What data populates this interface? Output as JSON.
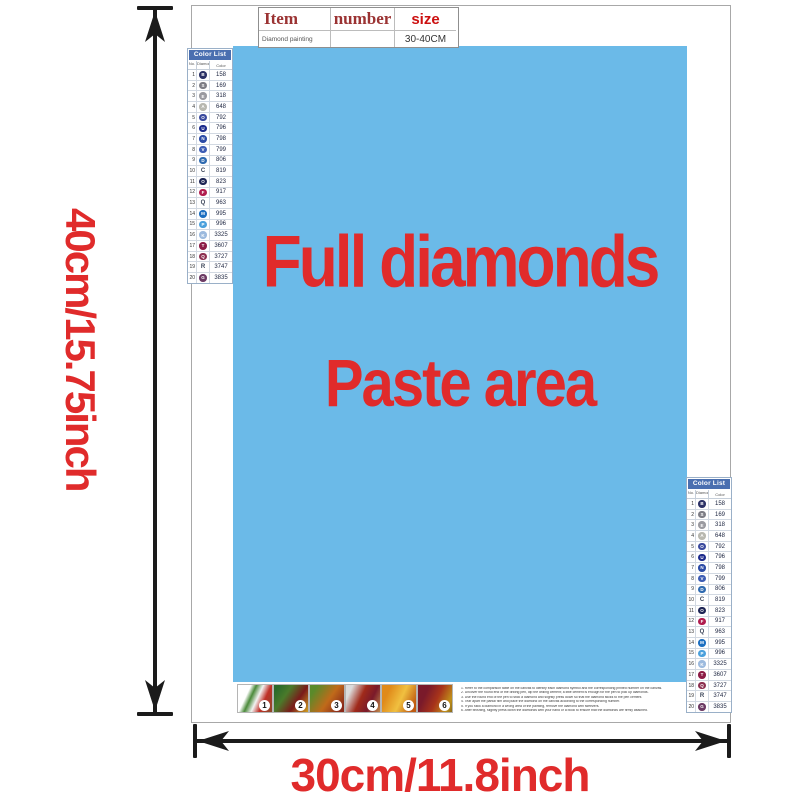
{
  "dimensions": {
    "height_label": "40cm/15.75inch",
    "width_label": "30cm/11.8inch",
    "accent_red": "#e02b2b"
  },
  "item_table": {
    "headers": [
      "Item",
      "number",
      "size"
    ],
    "row": {
      "item": "Diamond painting",
      "number": "",
      "size": "30-40CM"
    }
  },
  "paste_area": {
    "line1": "Full diamonds",
    "line2": "Paste area",
    "bg": "#6bbae8",
    "text_color": "#e02b2b"
  },
  "color_list": {
    "title": "Color List",
    "columns": [
      "No.",
      "Diamond",
      "Color"
    ],
    "header_bg": "#4a6fb0",
    "rows": [
      {
        "no": "1",
        "symbol": "B",
        "type": "circle",
        "circle": "#2b3166",
        "code": "158"
      },
      {
        "no": "2",
        "symbol": "S",
        "type": "circle",
        "circle": "#7d7d85",
        "code": "169"
      },
      {
        "no": "3",
        "symbol": "E",
        "type": "circle",
        "circle": "#9a9aa0",
        "code": "318"
      },
      {
        "no": "4",
        "symbol": "A",
        "type": "circle",
        "circle": "#b8b8b0",
        "code": "648"
      },
      {
        "no": "5",
        "symbol": "O",
        "type": "circle",
        "circle": "#3a4a9e",
        "code": "792"
      },
      {
        "no": "6",
        "symbol": "U",
        "type": "circle",
        "circle": "#1b2a8c",
        "code": "796"
      },
      {
        "no": "7",
        "symbol": "N",
        "type": "circle",
        "circle": "#2b4ba6",
        "code": "798"
      },
      {
        "no": "8",
        "symbol": "V",
        "type": "circle",
        "circle": "#3c5cb4",
        "code": "799"
      },
      {
        "no": "9",
        "symbol": "D",
        "type": "circle",
        "circle": "#2e6ab0",
        "code": "806"
      },
      {
        "no": "10",
        "symbol": "C",
        "type": "letter",
        "circle": "",
        "code": "819"
      },
      {
        "no": "11",
        "symbol": "O",
        "type": "circle",
        "circle": "#1c2454",
        "code": "823"
      },
      {
        "no": "12",
        "symbol": "F",
        "type": "circle",
        "circle": "#b01c4e",
        "code": "917"
      },
      {
        "no": "13",
        "symbol": "Q",
        "type": "letter",
        "circle": "",
        "code": "963"
      },
      {
        "no": "14",
        "symbol": "M",
        "type": "circle",
        "circle": "#1d6fc0",
        "code": "995"
      },
      {
        "no": "15",
        "symbol": "P",
        "type": "circle",
        "circle": "#4aa0dc",
        "code": "996"
      },
      {
        "no": "16",
        "symbol": "K",
        "type": "circle",
        "circle": "#9cbade",
        "code": "3325"
      },
      {
        "no": "17",
        "symbol": "T",
        "type": "circle",
        "circle": "#8c1c46",
        "code": "3607"
      },
      {
        "no": "18",
        "symbol": "Q",
        "type": "circle",
        "circle": "#8c3050",
        "code": "3727"
      },
      {
        "no": "19",
        "symbol": "R",
        "type": "letter",
        "circle": "",
        "code": "3747"
      },
      {
        "no": "20",
        "symbol": "G",
        "type": "circle",
        "circle": "#6c3a64",
        "code": "3835"
      }
    ]
  },
  "steps": {
    "numbers": [
      "1",
      "2",
      "3",
      "4",
      "5",
      "6"
    ]
  },
  "instructions": {
    "lines": [
      "1. Refer to the comparison table on the canvas to identify each diamond symbol and the corresponding printed number on the canvas.",
      "2. Uncover the round end of the drilling pen, dip the drilling cement; a little cement is enough for the pen to pick up diamonds.",
      "3. Use the round end of the pen to stick a diamond and slightly press down so that the diamond sticks to the pen cement.",
      "4. Tear apart the partial film and place the diamond on the canvas according to the corresponding number.",
      "5. If you stick a diamond in a wrong area of the painting, remove the diamond with tweezers.",
      "6. After finishing, slightly press down the diamonds with your hand or a book to ensure that the diamonds are firmly attached."
    ]
  }
}
